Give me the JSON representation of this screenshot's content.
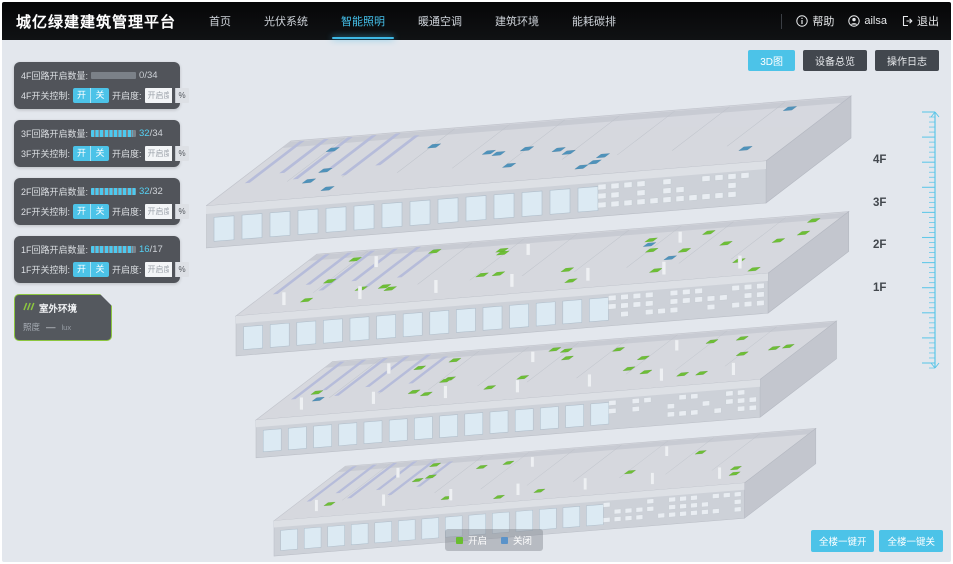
{
  "app": {
    "title": "城亿绿建建筑管理平台"
  },
  "nav": {
    "items": [
      {
        "key": "home",
        "label": "首页",
        "active": false
      },
      {
        "key": "pv-system",
        "label": "光伏系统",
        "active": false
      },
      {
        "key": "smart-lighting",
        "label": "智能照明",
        "active": true
      },
      {
        "key": "hvac",
        "label": "暖通空调",
        "active": false
      },
      {
        "key": "building-env",
        "label": "建筑环境",
        "active": false
      },
      {
        "key": "energy-carbon",
        "label": "能耗碳排",
        "active": false
      }
    ],
    "help_label": "帮助",
    "user_name": "ailsa",
    "logout_label": "退出"
  },
  "view_switcher": [
    {
      "key": "view-3d",
      "label": "3D图",
      "active": true
    },
    {
      "key": "device-overview",
      "label": "设备总览",
      "active": false
    },
    {
      "key": "operation-log",
      "label": "操作日志",
      "active": false
    }
  ],
  "floor_panels": [
    {
      "floor": "4F",
      "count_label": "4F回路开启数量:",
      "open": 0,
      "total": 34,
      "switch_label": "4F开关控制:",
      "on_label": "开",
      "off_label": "关",
      "dim_label": "开启度:",
      "dim_placeholder": "开启度",
      "percent_label": "%"
    },
    {
      "floor": "3F",
      "count_label": "3F回路开启数量:",
      "open": 32,
      "total": 34,
      "switch_label": "3F开关控制:",
      "on_label": "开",
      "off_label": "关",
      "dim_label": "开启度:",
      "dim_placeholder": "开启度",
      "percent_label": "%"
    },
    {
      "floor": "2F",
      "count_label": "2F回路开启数量:",
      "open": 32,
      "total": 32,
      "switch_label": "2F开关控制:",
      "on_label": "开",
      "off_label": "关",
      "dim_label": "开启度:",
      "dim_placeholder": "开启度",
      "percent_label": "%"
    },
    {
      "floor": "1F",
      "count_label": "1F回路开启数量:",
      "open": 16,
      "total": 17,
      "switch_label": "1F开关控制:",
      "on_label": "开",
      "off_label": "关",
      "dim_label": "开启度:",
      "dim_placeholder": "开启度",
      "percent_label": "%"
    }
  ],
  "outdoor_panel": {
    "title": "室外环境",
    "metric_label": "照度",
    "metric_value": "—",
    "metric_unit": "lux"
  },
  "floor_scale": {
    "labels": [
      "4F",
      "3F",
      "2F",
      "1F"
    ]
  },
  "legend": {
    "on_label": "开启",
    "on_color": "#69bd2f",
    "off_label": "关闭",
    "off_color": "#5b93c9"
  },
  "bulk_controls": [
    {
      "key": "all-on",
      "label": "全楼一键开"
    },
    {
      "key": "all-off",
      "label": "全楼一键关"
    }
  ],
  "building": {
    "floors": [
      {
        "name": "4F",
        "markers": 16,
        "marker_color": "#4a8fb8",
        "off_markers": 0
      },
      {
        "name": "3F",
        "markers": 26,
        "marker_color": "#69bd2f",
        "off_markers": 2
      },
      {
        "name": "2F",
        "markers": 24,
        "marker_color": "#69bd2f",
        "off_markers": 1
      },
      {
        "name": "1F",
        "markers": 13,
        "marker_color": "#69bd2f",
        "off_markers": 0
      }
    ],
    "off_marker_color": "#4a8fb8"
  },
  "colors": {
    "accent": "#4cc3e8",
    "ruler": "#56c5e8"
  }
}
